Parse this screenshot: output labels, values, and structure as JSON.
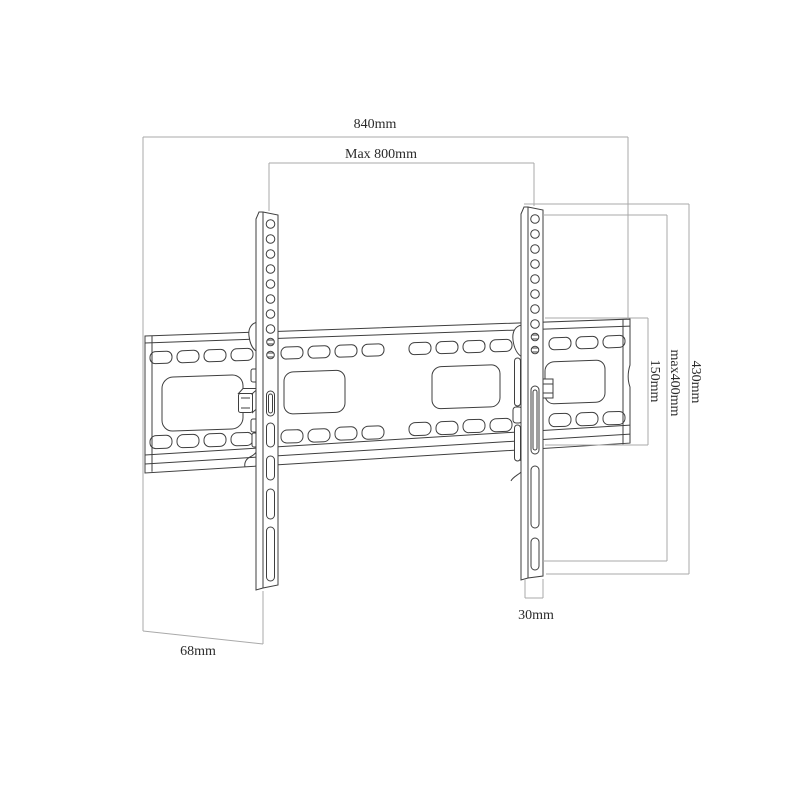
{
  "diagram": {
    "name": "tilting-tv-wall-mount-dimension-drawing",
    "colors": {
      "background": "#ffffff",
      "part_outline": "#3f3f3f",
      "dimension_line": "#a9a9a9",
      "label_text": "#2b2b2b"
    },
    "parts": {
      "wall_plate": "horizontal slotted wall plate",
      "left_bracket": "left vertical TV bracket arm",
      "right_bracket": "right vertical TV bracket arm"
    },
    "dimensions": {
      "total_width": {
        "label": "840mm",
        "value_mm": 840,
        "measures": "overall wall plate width"
      },
      "max_vesa_width": {
        "label": "Max 800mm",
        "value_mm": 800,
        "measures": "maximum horizontal hole spacing"
      },
      "plate_height": {
        "label": "150mm",
        "value_mm": 150,
        "measures": "wall plate height"
      },
      "max_vesa_height": {
        "label": "max400mm",
        "value_mm": 400,
        "measures": "maximum vertical hole spacing"
      },
      "bracket_height": {
        "label": "430mm",
        "value_mm": 430,
        "measures": "bracket arm overall height"
      },
      "bracket_width": {
        "label": "30mm",
        "value_mm": 30,
        "measures": "bracket arm width"
      },
      "depth": {
        "label": "68mm",
        "value_mm": 68,
        "measures": "distance from wall"
      }
    }
  }
}
